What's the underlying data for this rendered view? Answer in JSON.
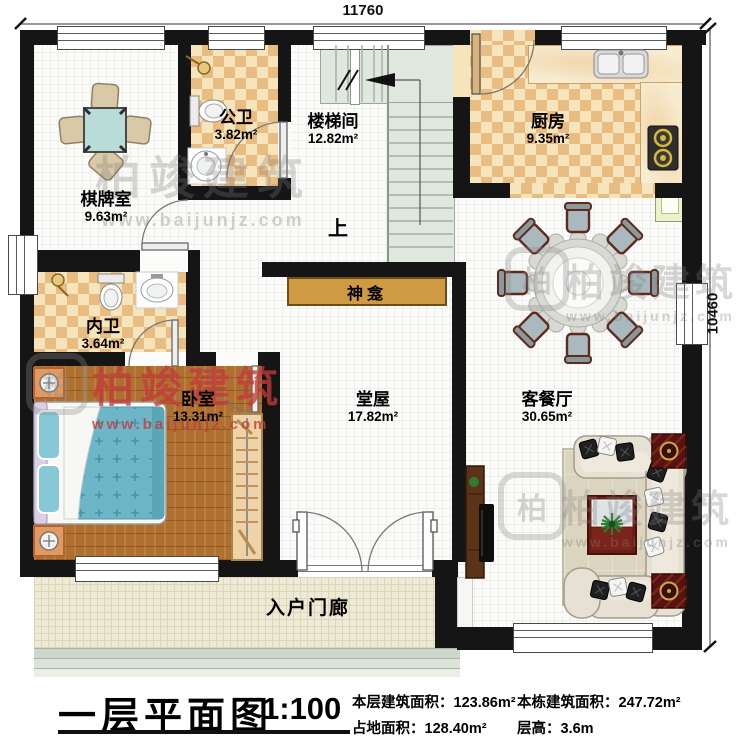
{
  "plan": {
    "dimensions": {
      "top": "11760",
      "right": "10460"
    },
    "rooms": [
      {
        "name": "棋牌室",
        "area": "9.63m²"
      },
      {
        "name": "公卫",
        "area": "3.82m²"
      },
      {
        "name": "楼梯间",
        "area": "12.82m²"
      },
      {
        "name": "厨房",
        "area": "9.35m²"
      },
      {
        "name": "内卫",
        "area": "3.64m²"
      },
      {
        "name": "卧室",
        "area": "13.31m²"
      },
      {
        "name": "堂屋",
        "area": "17.82m²"
      },
      {
        "name": "客餐厅",
        "area": "30.65m²"
      },
      {
        "name": "入户门廊",
        "area": ""
      }
    ],
    "annotations": {
      "shrine": "神龛",
      "stairs_up": "上"
    }
  },
  "watermark": {
    "brand": "柏竣建筑",
    "site": "www.baijunjz.com",
    "logo_char": "柏"
  },
  "title_block": {
    "title": "一层平面图",
    "scale": "1:100",
    "stats": [
      {
        "label": "本层建筑面积：",
        "value": "123.86m²"
      },
      {
        "label": "占地面积：",
        "value": "128.40m²"
      },
      {
        "label": "本栋建筑面积：",
        "value": "247.72m²"
      },
      {
        "label": "层高：",
        "value": "3.6m"
      }
    ]
  },
  "palette": {
    "wall": "#151515",
    "checker_dark": "#e9bc82",
    "checker_light": "#f6e4bd",
    "wood": "#ae6f2f",
    "stair": "#e0e7de",
    "porch": "#edead6",
    "shrine": "#cf9a44",
    "bed_teal": "#6db6c8",
    "watermark_red": "#c23b3b"
  }
}
